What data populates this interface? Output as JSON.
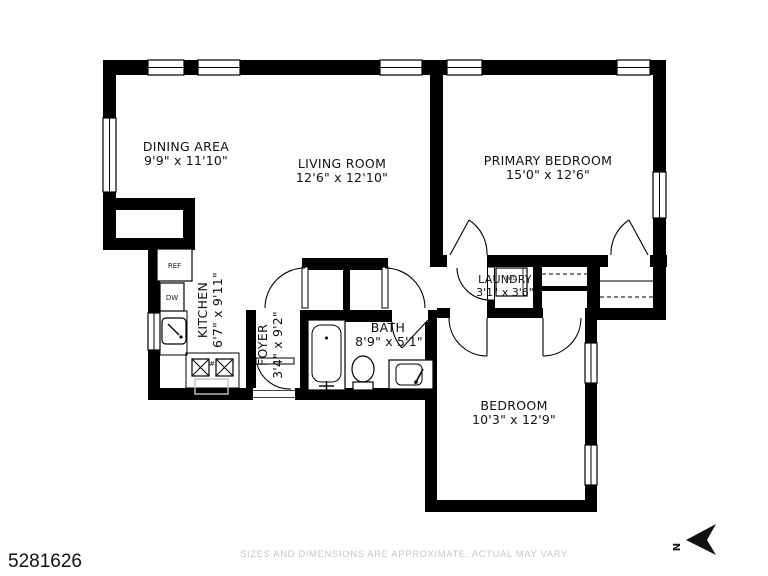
{
  "plan": {
    "rooms": [
      {
        "name": "DINING AREA",
        "dims": "9'9\" x 11'10\""
      },
      {
        "name": "LIVING ROOM",
        "dims": "12'6\" x 12'10\""
      },
      {
        "name": "PRIMARY BEDROOM",
        "dims": "15'0\" x 12'6\""
      },
      {
        "name": "KITCHEN",
        "dims": "6'7\" x 9'11\""
      },
      {
        "name": "FOYER",
        "dims": "3'4\" x 9'2\""
      },
      {
        "name": "BATH",
        "dims": "8'9\" x 5'1\""
      },
      {
        "name": "LAUNDRY",
        "dims": "3'1\" x 3'6\""
      },
      {
        "name": "BEDROOM",
        "dims": "10'3\" x 12'9\""
      }
    ],
    "appliances": {
      "ref": "REF",
      "dw": "DW",
      "wd": "W/D",
      "burner_mark": "#"
    },
    "compass_label": "N"
  },
  "footer": {
    "listing_number": "5281626",
    "disclaimer": "SIZES AND DIMENSIONS ARE APPROXIMATE, ACTUAL MAY VARY."
  },
  "colors": {
    "wall": "#000000",
    "disclaimer_text": "#c7c7c7",
    "label_text": "#111111"
  }
}
